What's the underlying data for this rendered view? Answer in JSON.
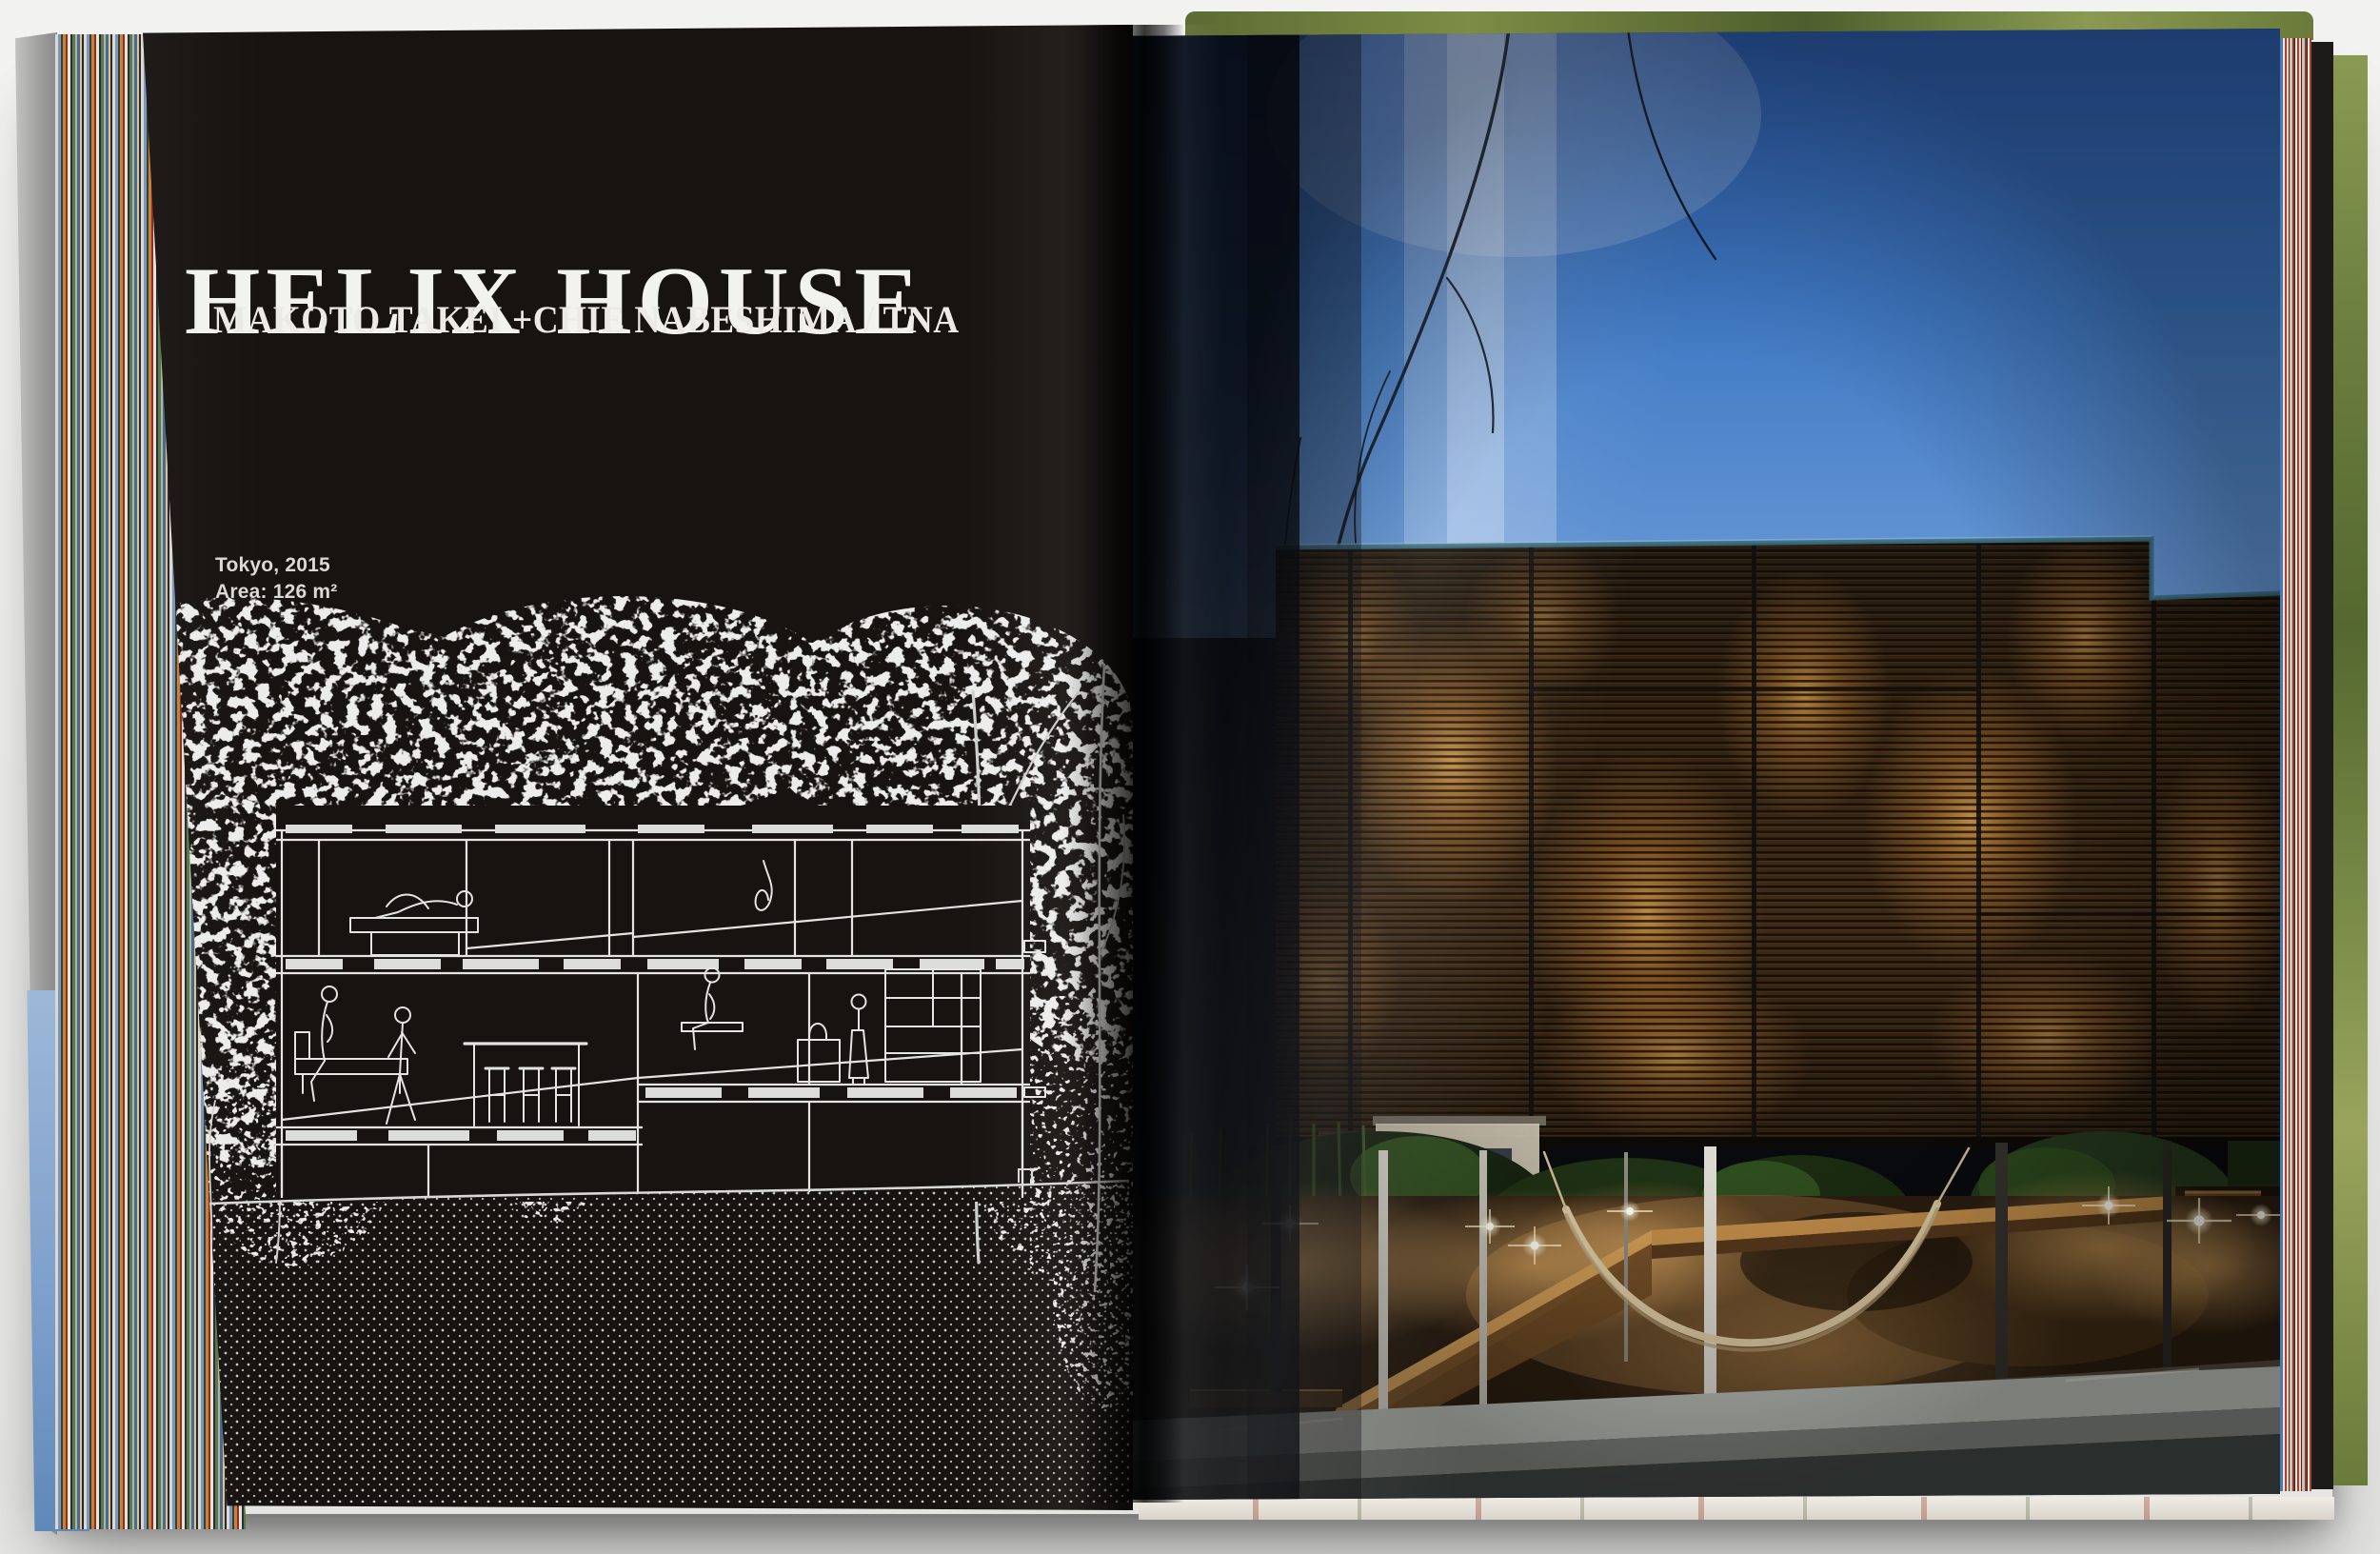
{
  "book": {
    "left_page": {
      "title": "HELIX HOUSE",
      "architects": "MAKOTO TAKEI +CHIE NABESHIMA / TNA",
      "meta": {
        "location": "Tokyo, 2015",
        "area": "Area: 126 m²"
      },
      "drawing": {
        "kind": "architectural-cross-section",
        "subject": "three-storey house section in white line art surrounded by tree silhouettes, figures inside, dotted earth hatch below"
      }
    },
    "right_page": {
      "photo": {
        "subject": "timber-louvred house glowing from within at dusk, raised on slender columns over a landscaped mound with hammock, ramp and garden lights"
      }
    }
  },
  "colors": {
    "backdrop": "#f2f2f0",
    "page_black": "#171310",
    "title_white": "#f2f2ef",
    "sky_blue": "#3f79c4",
    "sky_deep": "#2b59a6",
    "sky_light": "#6c9cd8",
    "slat_amber": "#b36a2b",
    "glow_warm": "#f2b055",
    "ground_amber": "#9c713d",
    "foliage_green": "#39511f",
    "curb_gray": "#b8bcb4",
    "board_gray": "#9d9d9b"
  },
  "page_edge_colors": [
    "#7a96bc",
    "#c8803e",
    "#8a2f22",
    "#5c7a46",
    "#25303c",
    "#d8d4cc",
    "#a9422e",
    "#4a7ab0"
  ]
}
